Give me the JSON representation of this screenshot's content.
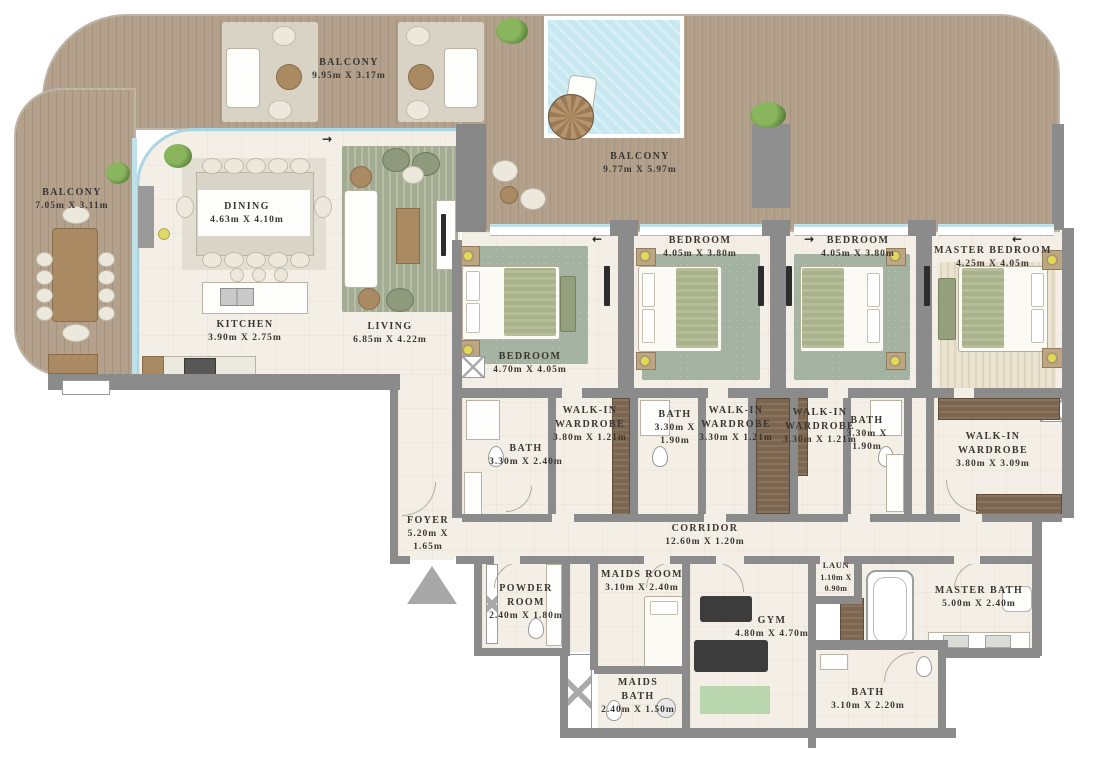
{
  "plan": {
    "rooms": [
      {
        "name": "BALCONY",
        "dims": "9.95m X 3.17m"
      },
      {
        "name": "BALCONY",
        "dims": "7.05m X 3.11m"
      },
      {
        "name": "DINING",
        "dims": "4.63m X 4.10m"
      },
      {
        "name": "KITCHEN",
        "dims": "3.90m X 2.75m"
      },
      {
        "name": "LIVING",
        "dims": "6.85m X 4.22m"
      },
      {
        "name": "BALCONY",
        "dims": "9.77m X 5.97m"
      },
      {
        "name": "BEDROOM",
        "dims": "4.70m X 4.05m"
      },
      {
        "name": "BEDROOM",
        "dims": "4.05m X 3.80m"
      },
      {
        "name": "BEDROOM",
        "dims": "4.05m X 3.80m"
      },
      {
        "name": "MASTER BEDROOM",
        "dims": "4.25m X 4.05m"
      },
      {
        "name": "BATH",
        "dims": "3.30m X 2.40m"
      },
      {
        "name": "WALK-IN WARDROBE",
        "dims": "3.80m X 1.21m"
      },
      {
        "name": "BATH",
        "dims": "3.30m X 1.90m"
      },
      {
        "name": "WALK-IN WARDROBE",
        "dims": "3.30m X 1.21m"
      },
      {
        "name": "WALK-IN WARDROBE",
        "dims": "3.30m X 1.21m"
      },
      {
        "name": "BATH",
        "dims": "3.30m X 1.90m"
      },
      {
        "name": "WALK-IN WARDROBE",
        "dims": "3.80m X 3.09m"
      },
      {
        "name": "FOYER",
        "dims": "5.20m X 1.65m"
      },
      {
        "name": "CORRIDOR",
        "dims": "12.60m X 1.20m"
      },
      {
        "name": "POWDER ROOM",
        "dims": "2.40m X 1.80m"
      },
      {
        "name": "MAIDS ROOM",
        "dims": "3.10m X 2.40m"
      },
      {
        "name": "MAIDS BATH",
        "dims": "2.40m X 1.50m"
      },
      {
        "name": "GYM",
        "dims": "4.80m X 4.70m"
      },
      {
        "name": "LAUN",
        "dims": "1.10m X 0.90m"
      },
      {
        "name": "MASTER BATH",
        "dims": "5.00m X 2.40m"
      },
      {
        "name": "BATH",
        "dims": "3.10m X 2.20m"
      }
    ],
    "arrows": [
      "→",
      "←",
      "→",
      "←"
    ],
    "colors": {
      "wall": "#8b8b8b",
      "wood_deck": "#b3a18c",
      "floor": "#f4efe6",
      "pool": "#c7e8f1",
      "rug_green": "#a4b2a2",
      "blanket_green": "#a9b28a",
      "wardrobe_brown": "#7c654e",
      "label_text": "#3a3631"
    }
  }
}
